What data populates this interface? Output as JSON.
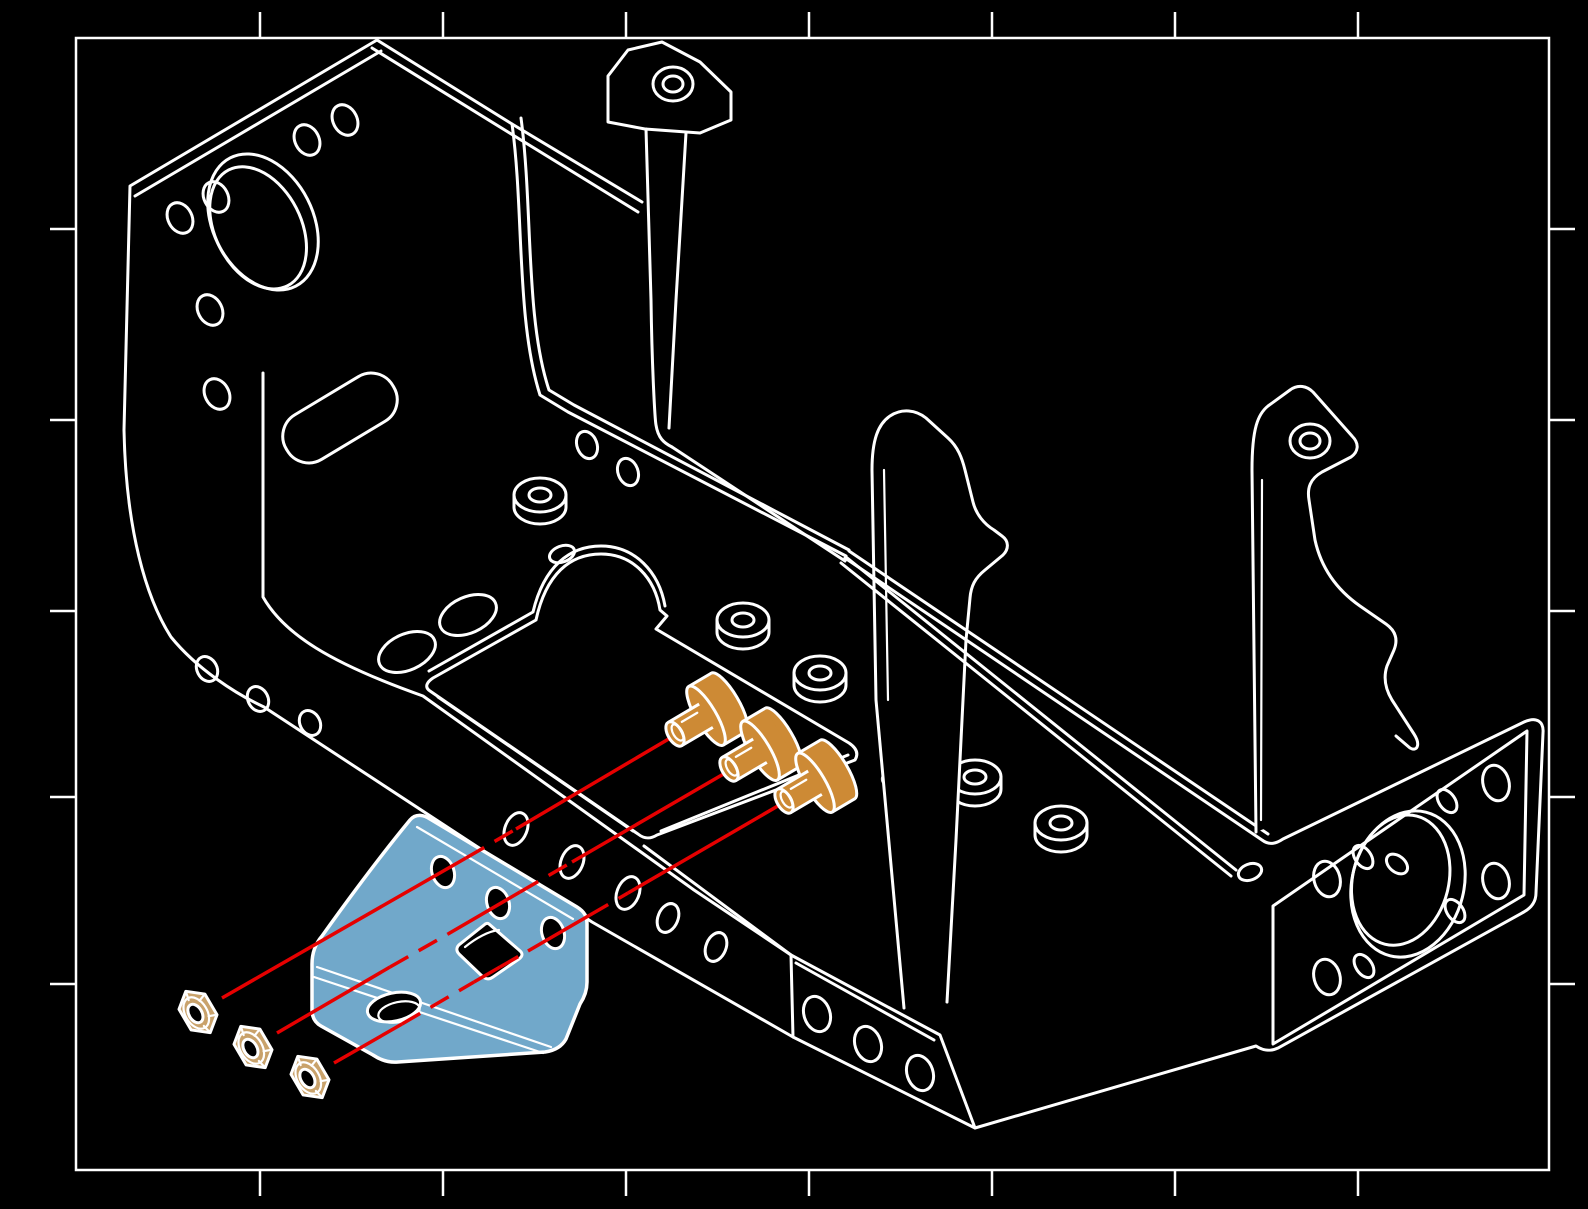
{
  "grid": {
    "columns": [
      "1",
      "2",
      "3",
      "4",
      "5",
      "6",
      "7",
      "8"
    ],
    "rows": [
      "A",
      "B",
      "C",
      "D",
      "E",
      "F"
    ]
  },
  "colors": {
    "background": "#000000",
    "line": "#ffffff",
    "highlight_bracket": "#71a8ca",
    "screw": "#cd8a35",
    "nut": "#c9a26b",
    "assembly_line": "#e60000"
  },
  "parts": {
    "highlighted_bracket_count": 1,
    "bracket_face_hole_count": 3,
    "screw_count": 3,
    "nut_count": 3,
    "assembly_line_count": 3
  }
}
